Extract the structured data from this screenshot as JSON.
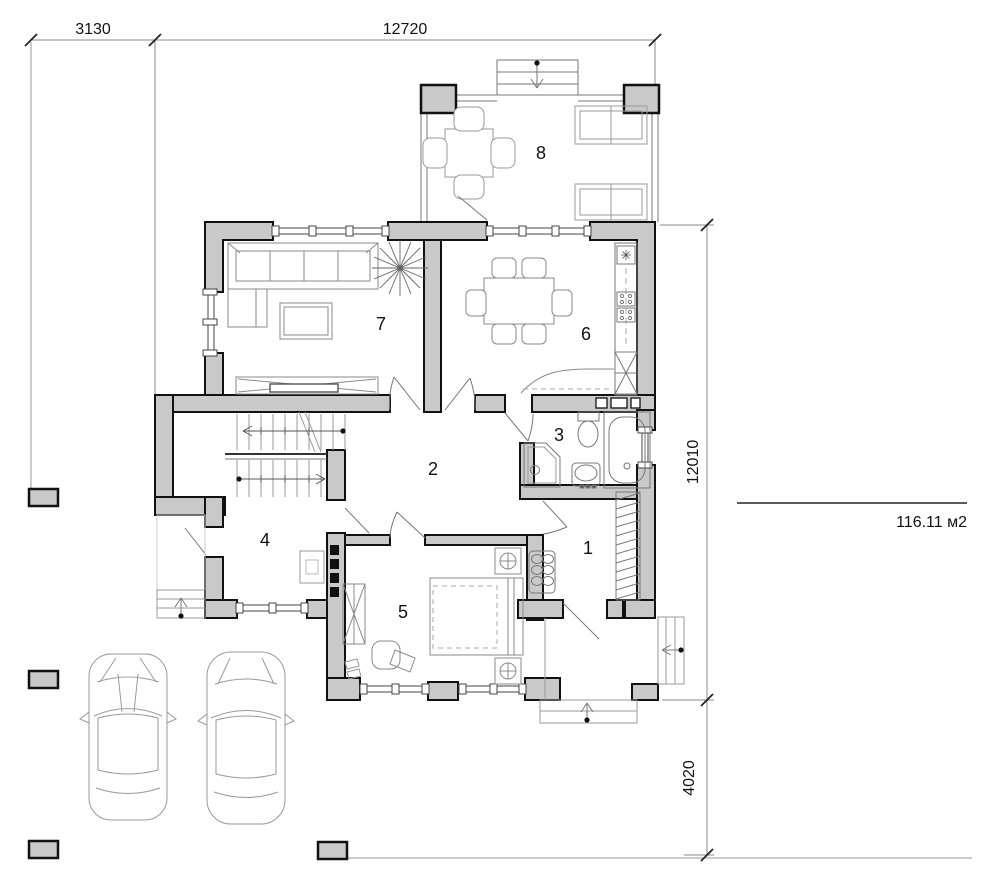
{
  "plan": {
    "area_label": "116.11 м2",
    "dimensions": {
      "top_left_width": "3130",
      "top_main_width": "12720",
      "right_main_height": "12010",
      "right_porch_height": "4020"
    },
    "rooms": [
      {
        "number": "1"
      },
      {
        "number": "2"
      },
      {
        "number": "3"
      },
      {
        "number": "4"
      },
      {
        "number": "5"
      },
      {
        "number": "6"
      },
      {
        "number": "7"
      },
      {
        "number": "8"
      }
    ],
    "symbols": {
      "colors": {
        "wall_fill": "#c9c9c9",
        "wall_stroke": "#111111",
        "furniture_line": "#8a8a8a",
        "dimension_line": "#777777"
      },
      "furniture_icons": [
        "corner-sofa-icon",
        "coffee-table-icon",
        "tv-stand-icon",
        "plant-icon",
        "dining-table-icon",
        "kitchen-counter-icon",
        "kitchen-sink-icon",
        "stove-icon",
        "fridge-icon",
        "bathtub-icon",
        "toilet-icon",
        "corner-shower-icon",
        "washbasin-icon",
        "double-bed-icon",
        "nightstand-lamp-icon",
        "wardrobe-icon",
        "desk-chair-icon",
        "staircase-icon",
        "terrace-table-icon",
        "terrace-sofa-icon",
        "entry-bench-icon",
        "hall-closet-icon",
        "car-top-view-icon",
        "fence-post-icon",
        "entry-steps-icon"
      ]
    }
  }
}
